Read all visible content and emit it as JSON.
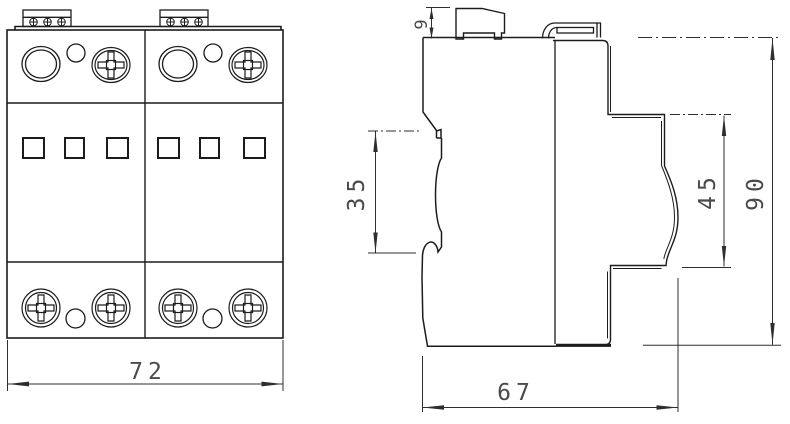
{
  "colors": {
    "outline": "#1c1c1c",
    "dimension_line": "#2e2e2e",
    "dimension_text": "#4a4a4a",
    "background": "#ffffff"
  },
  "dimensions": {
    "front_width": "72",
    "terminal_height": "9",
    "rail_recess_height": "35",
    "front_section_height": "45",
    "overall_height": "90",
    "overall_depth": "67"
  }
}
